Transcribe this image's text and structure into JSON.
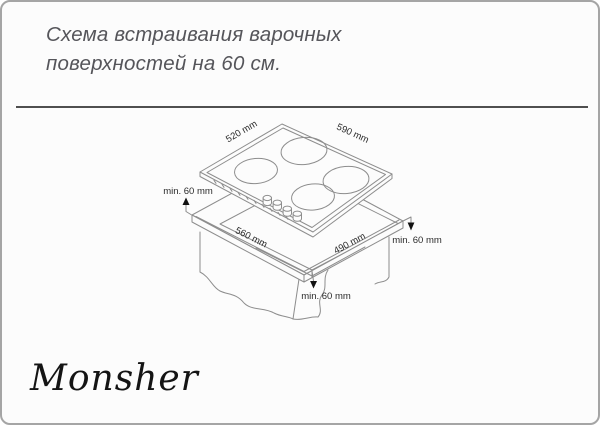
{
  "header": {
    "title_line1": "Схема встраивания варочных",
    "title_line2": "поверхностей на 60 см."
  },
  "brand": {
    "logo_text": "Monsher"
  },
  "diagram": {
    "type": "isometric-installation-drawing",
    "hob_depth_label": "520 mm",
    "hob_width_label": "590 mm",
    "cutout_width_label": "560 mm",
    "cutout_depth_label": "490 mm",
    "clearance_back_label": "min. 60 mm",
    "clearance_right_label": "min. 60 mm",
    "clearance_front_label": "min. 60 mm",
    "colors": {
      "line": "#8d8d8d",
      "rule": "#4f4f4f",
      "title_text": "#55555a",
      "dim_text": "#2b2b2b",
      "arrow": "#111111"
    }
  }
}
